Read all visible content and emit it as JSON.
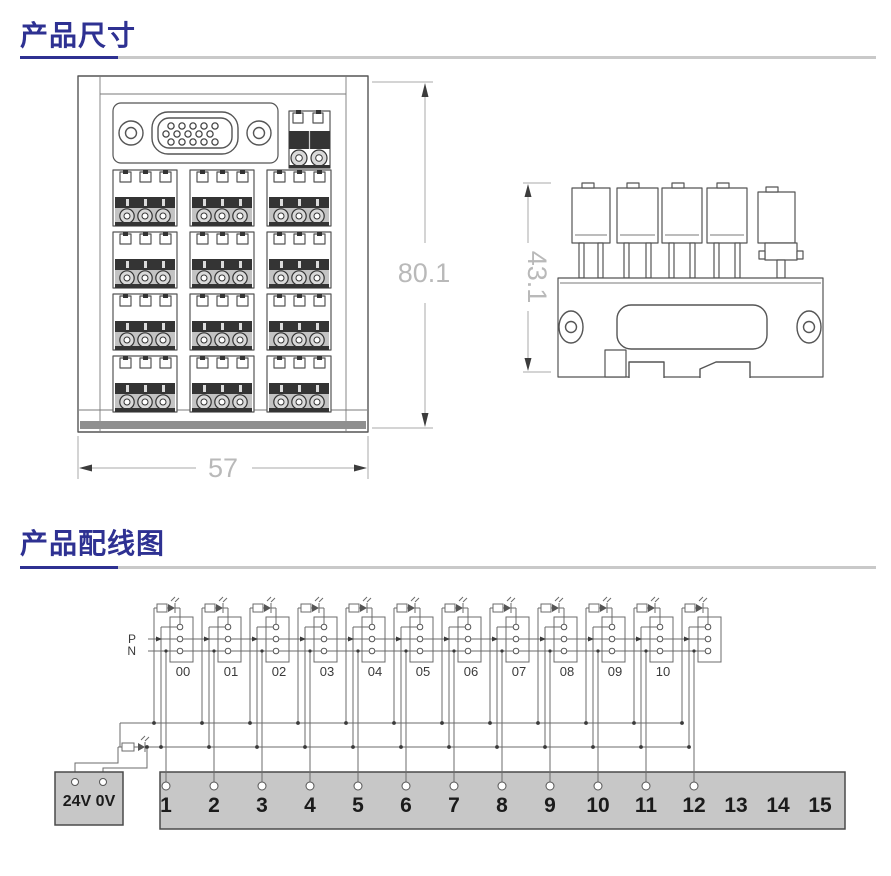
{
  "colors": {
    "heading": "#2e3192",
    "underline_gray": "#c9c9c9",
    "drawing_line": "#555555",
    "dimension_text": "#b9b9b9",
    "panel_gray": "#c7c7c7",
    "wire": "#6b6b6b"
  },
  "sections": {
    "dimensions": {
      "title": "产品尺寸"
    },
    "wiring": {
      "title": "产品配线图"
    }
  },
  "dimension_drawing": {
    "front_width_label": "57",
    "front_height_label": "80.1",
    "side_height_label": "43.1"
  },
  "wiring_diagram": {
    "p_label": "P",
    "n_label": "N",
    "relay_labels": [
      "00",
      "01",
      "02",
      "03",
      "04",
      "05",
      "06",
      "07",
      "08",
      "09",
      "10"
    ],
    "unlabeled_units": 1,
    "power_box_label": "24V 0V",
    "terminals": [
      "1",
      "2",
      "3",
      "4",
      "5",
      "6",
      "7",
      "8",
      "9",
      "10",
      "11",
      "12",
      "13",
      "14",
      "15"
    ],
    "wired_terminals": 12
  }
}
